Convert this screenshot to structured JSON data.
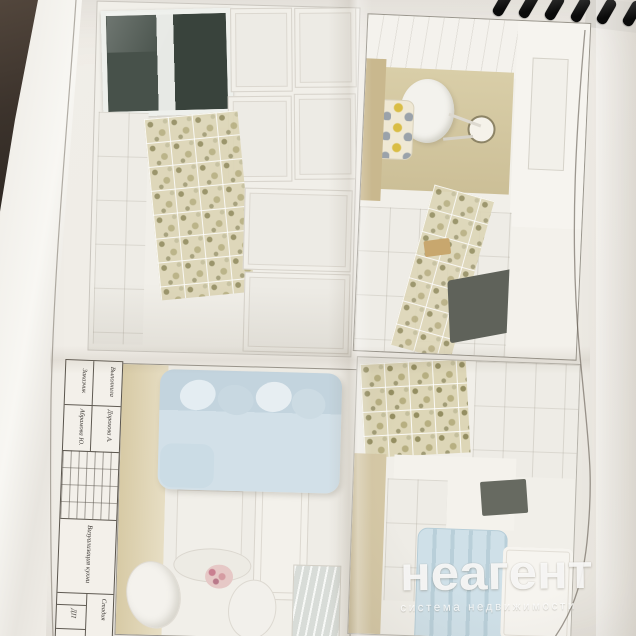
{
  "watermark": {
    "brand": "неагент",
    "tagline": "система недвижимости",
    "color": "#ffffff"
  },
  "title_block": {
    "rows": [
      {
        "label": "Выполнила",
        "value": "Дорохова А."
      },
      {
        "label": "Заказчик",
        "value": "Абрамова Ю."
      }
    ],
    "drawing_title": "Визуализация кухни",
    "stage_label": "Стадия",
    "stage_value": "ДП"
  },
  "colors": {
    "desk_surface": "#3c332c",
    "page": "#efece6",
    "coil_black": "#141414",
    "tile_olive": "#b3ab7e",
    "wall_olive": "#d5c9a3",
    "sofa_blue": "#cddde6",
    "counter_gray": "#5f625a",
    "watermark_white": "#ffffff"
  }
}
